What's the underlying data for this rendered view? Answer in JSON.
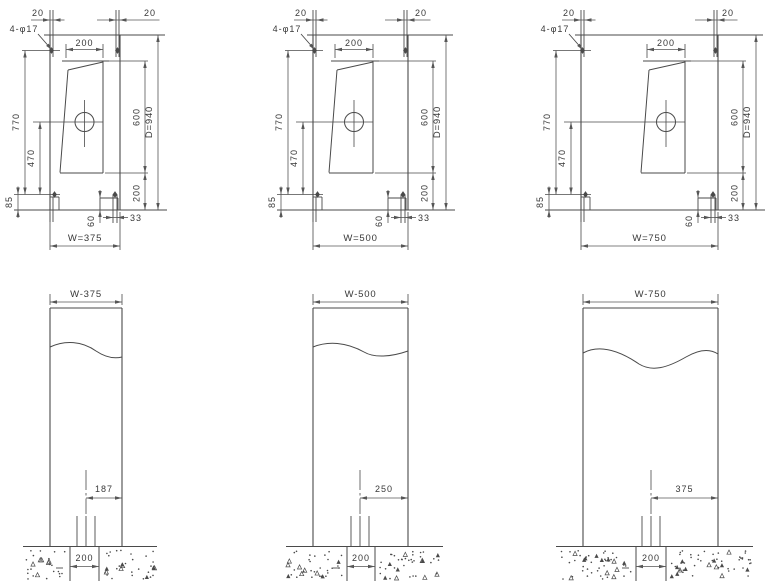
{
  "drawing": {
    "title": "enclosure-dimension-drawing",
    "plan_views": [
      {
        "name": "plan-view-w375",
        "labels": {
          "anchor_spec": "4-φ17",
          "top_offset_left": "20",
          "top_offset_right": "20",
          "door_width": "200",
          "bolt_span": "770",
          "center_to_bolt": "470",
          "bolt_edge": "85",
          "foot_width": "60",
          "foot_offset": "33",
          "door_height": "600",
          "door_bottom_gap": "200",
          "depth": "D=940",
          "width": "W=375"
        }
      },
      {
        "name": "plan-view-w500",
        "labels": {
          "anchor_spec": "4-φ17",
          "top_offset_left": "20",
          "top_offset_right": "20",
          "door_width": "200",
          "bolt_span": "770",
          "center_to_bolt": "470",
          "bolt_edge": "85",
          "foot_width": "60",
          "foot_offset": "33",
          "door_height": "600",
          "door_bottom_gap": "200",
          "depth": "D=940",
          "width": "W=500"
        }
      },
      {
        "name": "plan-view-w750",
        "labels": {
          "anchor_spec": "4-φ17",
          "top_offset_left": "20",
          "top_offset_right": "20",
          "door_width": "200",
          "bolt_span": "770",
          "center_to_bolt": "470",
          "bolt_edge": "85",
          "foot_width": "60",
          "foot_offset": "33",
          "door_height": "600",
          "door_bottom_gap": "200",
          "depth": "D=940",
          "width": "W=750"
        }
      }
    ],
    "elevation_views": [
      {
        "name": "elevation-view-w375",
        "labels": {
          "width": "W-375",
          "center_to_edge": "187",
          "conduit_width": "200"
        }
      },
      {
        "name": "elevation-view-w500",
        "labels": {
          "width": "W-500",
          "center_to_edge": "250",
          "conduit_width": "200"
        }
      },
      {
        "name": "elevation-view-w750",
        "labels": {
          "width": "W-750",
          "center_to_edge": "375",
          "conduit_width": "200"
        }
      }
    ]
  },
  "colors": {
    "line": "#4a4a4a",
    "dim_line": "#565656",
    "text": "#383838",
    "background": "#ffffff"
  }
}
